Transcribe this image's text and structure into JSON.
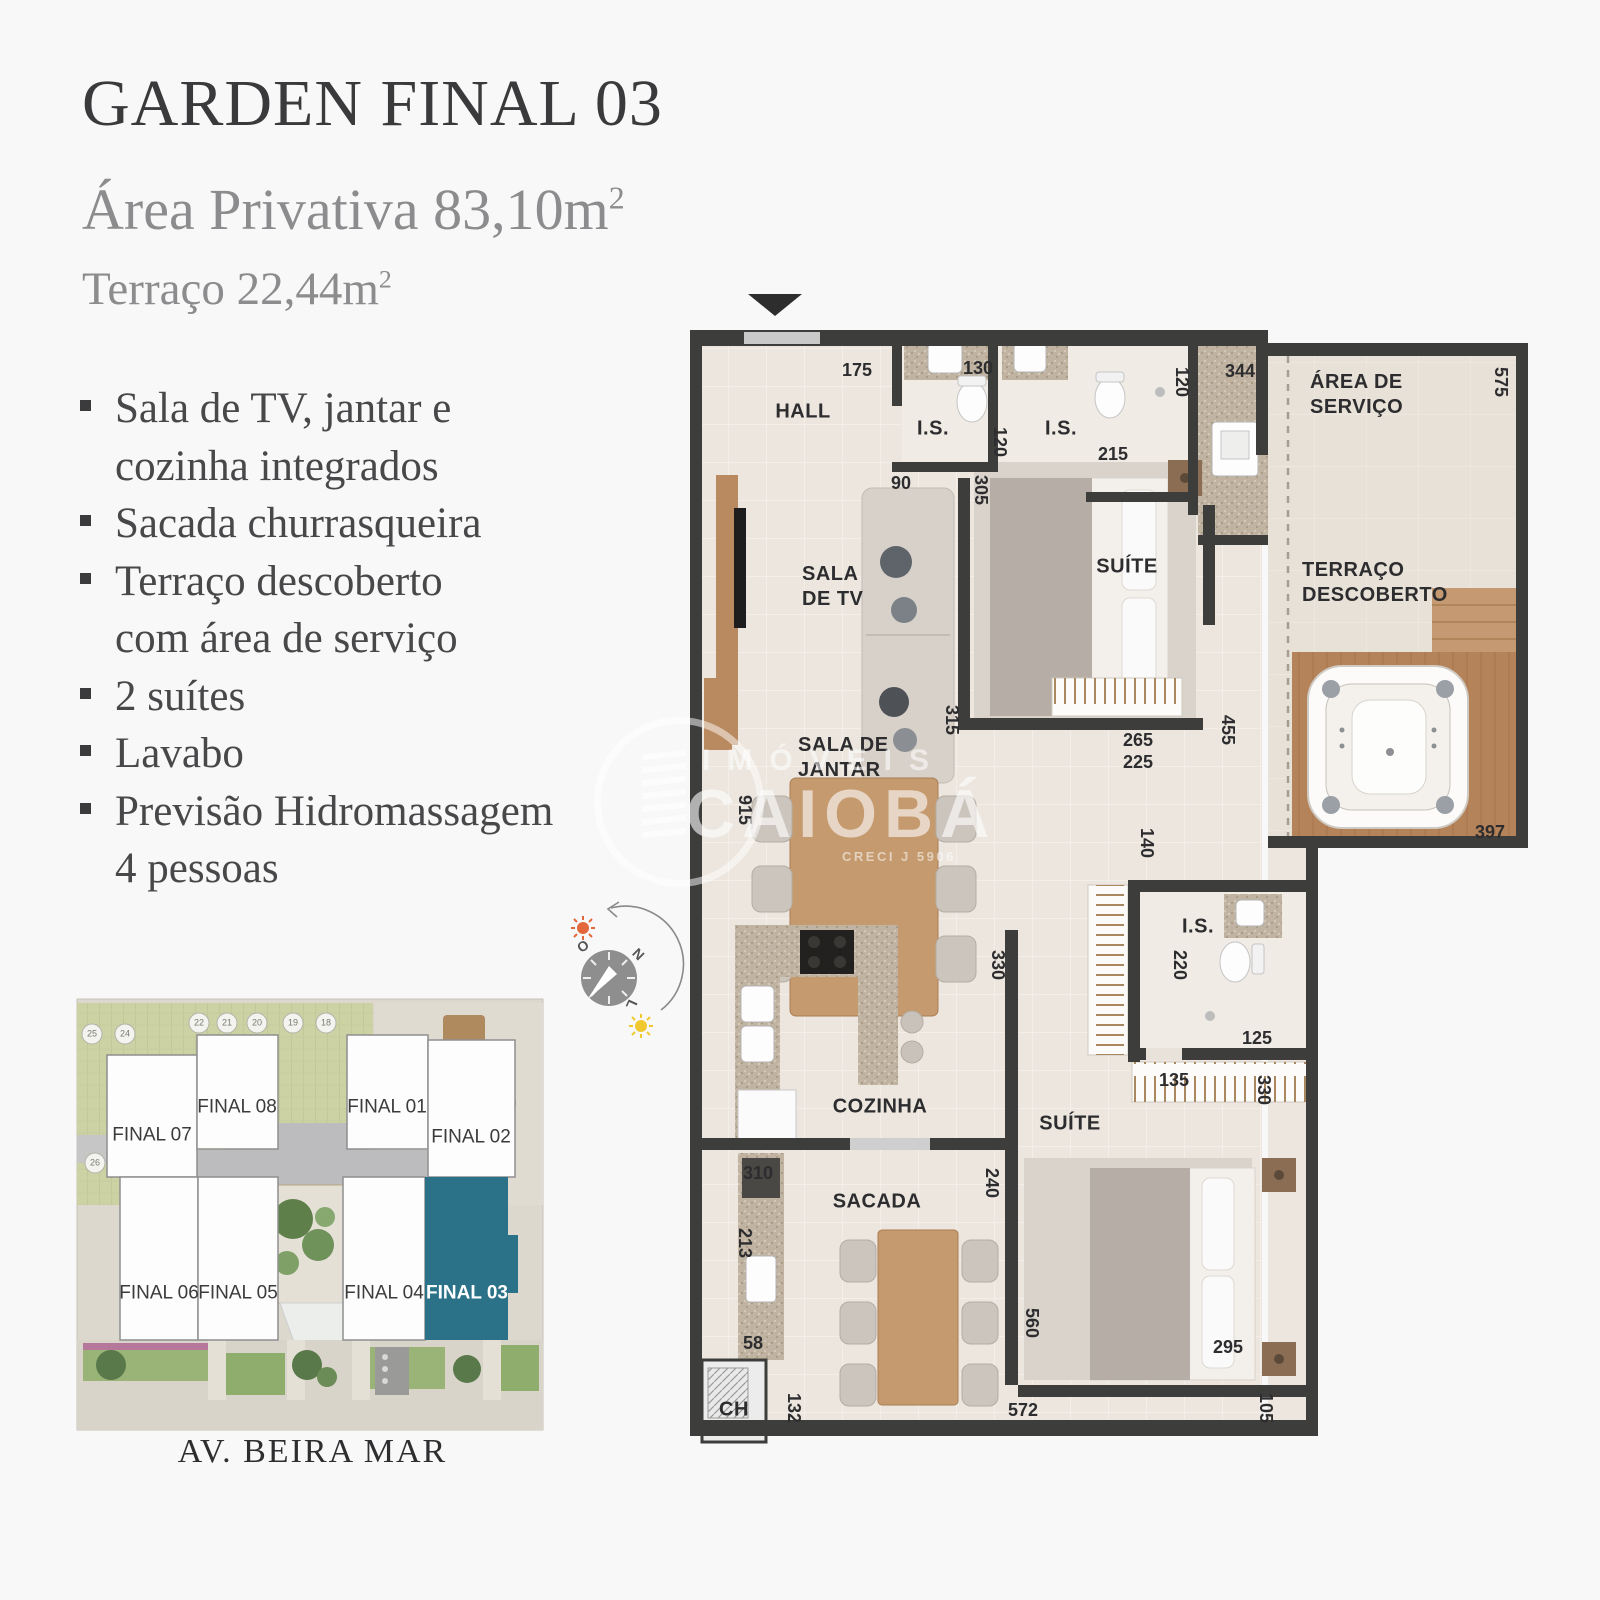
{
  "header": {
    "title": "GARDEN FINAL 03",
    "private_area": "Área Privativa 83,10m",
    "private_area_sup": "2",
    "terrace_area": "Terraço 22,44m",
    "terrace_area_sup": "2"
  },
  "features": {
    "items": [
      {
        "lines": [
          "Sala de TV, jantar e",
          "cozinha integrados"
        ]
      },
      {
        "lines": [
          "Sacada churrasqueira"
        ]
      },
      {
        "lines": [
          "Terraço descoberto",
          "com área de serviço"
        ]
      },
      {
        "lines": [
          "2 suítes"
        ]
      },
      {
        "lines": [
          "Lavabo"
        ]
      },
      {
        "lines": [
          "Previsão Hidromassagem",
          "4 pessoas"
        ]
      }
    ]
  },
  "plan": {
    "rooms": {
      "hall": "HALL",
      "is1": "I.S.",
      "is2": "I.S.",
      "area_servico": "ÁREA DE\nSERVIÇO",
      "sala_tv": "SALA\nDE TV",
      "suite1": "SUÍTE",
      "terraco": "TERRAÇO\nDESCOBERTO",
      "sala_jantar": "SALA DE\nJANTAR",
      "cozinha": "COZINHA",
      "sacada": "SACADA",
      "suite2": "SUÍTE",
      "is3": "I.S.",
      "ch": "CH"
    },
    "dims": [
      "175",
      "130",
      "120",
      "215",
      "120",
      "344",
      "575",
      "90",
      "305",
      "915",
      "315",
      "265",
      "225",
      "455",
      "140",
      "397",
      "330",
      "220",
      "125",
      "135",
      "330",
      "310",
      "240",
      "213",
      "560",
      "58",
      "295",
      "132",
      "572",
      "105"
    ]
  },
  "site": {
    "units": [
      "FINAL 07",
      "FINAL 08",
      "FINAL 01",
      "FINAL 02",
      "FINAL 06",
      "FINAL 05",
      "FINAL 04",
      "FINAL 03"
    ],
    "highlighted_unit": "FINAL 03",
    "parking": [
      "25",
      "24",
      "22",
      "21",
      "20",
      "19",
      "18",
      "26"
    ],
    "avenue": "AV. BEIRA MAR"
  },
  "compass": {
    "west": "O",
    "north": "N",
    "east": "L"
  },
  "watermark": {
    "line1": "IMÓVEIS",
    "line2": "CAIOBÁ",
    "creci": "CRECI J 5906"
  },
  "colors": {
    "accent_teal": "#2b7289",
    "wall": "#3d3d3c",
    "floor": "#ece6df",
    "wood": "#b9895f"
  }
}
